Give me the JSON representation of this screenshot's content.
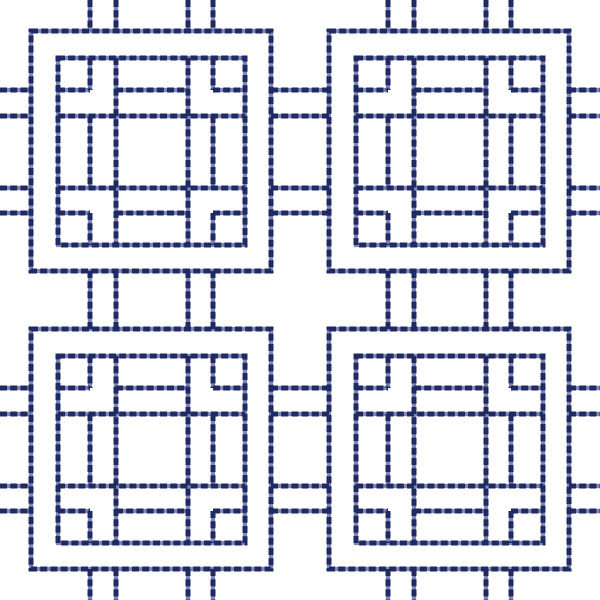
{
  "artwork": {
    "kind": "stitched-square-lattice-pattern",
    "background": "#ffffff",
    "stitch": {
      "dark": "#1f2a63",
      "light": "#7d86b5",
      "stroke_width": 5,
      "underlay_width": 4.2,
      "dash_on": 7,
      "dash_off": 3.2
    },
    "layout": {
      "canvas_size": 600,
      "motif_origins": [
        31,
        329
      ],
      "motif_size": 240,
      "inner_inset": 27,
      "inner_size": 187,
      "outside_intervals": [
        [
          0,
          31
        ],
        [
          271,
          329
        ],
        [
          569,
          600
        ]
      ]
    },
    "motif_lines": [
      {
        "offset": 59,
        "type": "edge"
      },
      {
        "offset": 85,
        "type": "main"
      },
      {
        "offset": 157,
        "type": "main"
      },
      {
        "offset": 182,
        "type": "edge"
      }
    ],
    "segments": {
      "edge": [
        [
          27,
          59
        ],
        [
          85,
          157
        ],
        [
          182,
          214
        ]
      ],
      "main": [
        [
          27,
          214
        ]
      ]
    }
  }
}
